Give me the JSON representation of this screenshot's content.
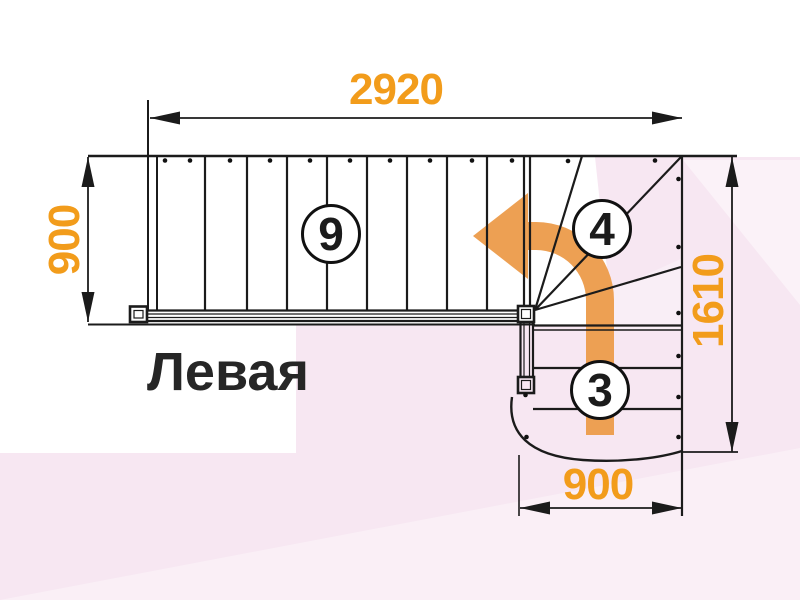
{
  "title": {
    "text": "Левая"
  },
  "dimensions": {
    "top_width_mm": "2920",
    "left_flight_width_mm": "900",
    "right_height_mm": "1610",
    "bottom_flight_width_mm": "900"
  },
  "steps": {
    "upper_flight_count": "9",
    "winder_count": "4",
    "lower_flight_count": "3"
  },
  "icons": {
    "direction_arrow": "curved-left-up-arrow-icon"
  },
  "colors": {
    "accent_text_orange": "#F29C1B",
    "arrow_orange": "#EDA053",
    "line_black": "#1B1B1B",
    "background_pink": "#F7E7F2",
    "paper_white": "#FFFFFF"
  }
}
